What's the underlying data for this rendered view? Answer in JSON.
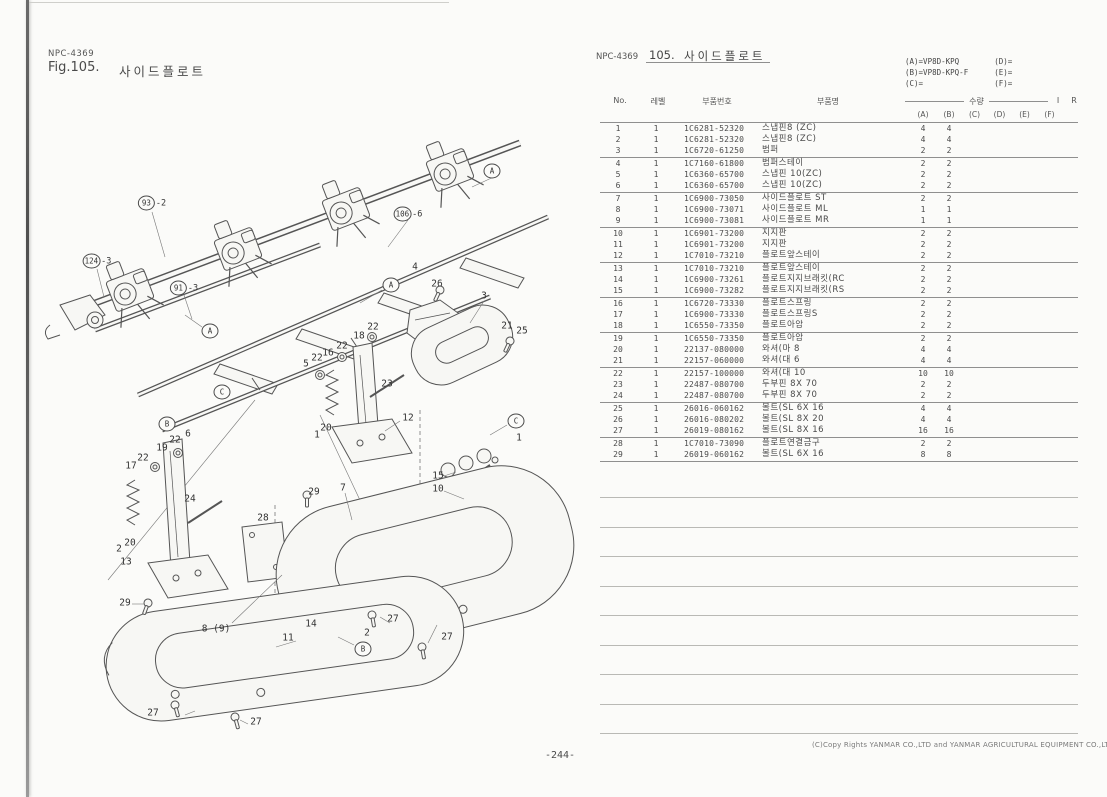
{
  "page": {
    "code_left": "NPC-4369",
    "fig_label": "Fig.105.",
    "fig_title": "사이드플로트",
    "code_right": "NPC-4369",
    "fig_no_right": "105.",
    "title_right": "사이드플로트",
    "footer_copyright": "(C)Copy Rights  YANMAR CO.,LTD and YANMAR AGRICULTURAL EQUIPMENT CO.,LTD.",
    "page_number": "-244-"
  },
  "models": [
    {
      "label": "(A)",
      "value": "VP8D-KPQ"
    },
    {
      "label": "(B)",
      "value": "VP8D-KPQ-F"
    },
    {
      "label": "(C)",
      "value": ""
    },
    {
      "label": "(D)",
      "value": ""
    },
    {
      "label": "(E)",
      "value": ""
    },
    {
      "label": "(F)",
      "value": ""
    }
  ],
  "table": {
    "col_no": "No.",
    "col_level": "레벨",
    "col_part_no": "부품번호",
    "col_part_name": "부품명",
    "col_qty": "수량",
    "col_i": "I",
    "col_r": "R",
    "qty_cols": [
      "(A)",
      "(B)",
      "(C)",
      "(D)",
      "(E)",
      "(F)"
    ],
    "rows": [
      {
        "no": "1",
        "level": "1",
        "part_no": "1C6281-52320",
        "name": "스냅핀8 (ZC)",
        "qa": "4",
        "qb": "4"
      },
      {
        "no": "2",
        "level": "1",
        "part_no": "1C6281-52320",
        "name": "스냅핀8 (ZC)",
        "qa": "4",
        "qb": "4"
      },
      {
        "no": "3",
        "level": "1",
        "part_no": "1C6720-61250",
        "name": "범퍼",
        "qa": "2",
        "qb": "2"
      },
      {
        "no": "4",
        "level": "1",
        "part_no": "1C7160-61800",
        "name": "범퍼스테이",
        "qa": "2",
        "qb": "2"
      },
      {
        "no": "5",
        "level": "1",
        "part_no": "1C6360-65700",
        "name": "스냅핀 10(ZC)",
        "qa": "2",
        "qb": "2"
      },
      {
        "no": "6",
        "level": "1",
        "part_no": "1C6360-65700",
        "name": "스냅핀 10(ZC)",
        "qa": "2",
        "qb": "2"
      },
      {
        "no": "7",
        "level": "1",
        "part_no": "1C6900-73050",
        "name": "사이드플로트 ST",
        "qa": "2",
        "qb": "2"
      },
      {
        "no": "8",
        "level": "1",
        "part_no": "1C6900-73071",
        "name": "사이드플로트 ML",
        "qa": "1",
        "qb": "1"
      },
      {
        "no": "9",
        "level": "1",
        "part_no": "1C6900-73081",
        "name": "사이드플로트 MR",
        "qa": "1",
        "qb": "1"
      },
      {
        "no": "10",
        "level": "1",
        "part_no": "1C6901-73200",
        "name": "지지판",
        "qa": "2",
        "qb": "2"
      },
      {
        "no": "11",
        "level": "1",
        "part_no": "1C6901-73200",
        "name": "지지판",
        "qa": "2",
        "qb": "2"
      },
      {
        "no": "12",
        "level": "1",
        "part_no": "1C7010-73210",
        "name": "플로트앞스테이",
        "qa": "2",
        "qb": "2"
      },
      {
        "no": "13",
        "level": "1",
        "part_no": "1C7010-73210",
        "name": "플로트앞스테이",
        "qa": "2",
        "qb": "2"
      },
      {
        "no": "14",
        "level": "1",
        "part_no": "1C6900-73261",
        "name": "플로트지지브래킷(RC",
        "qa": "2",
        "qb": "2"
      },
      {
        "no": "15",
        "level": "1",
        "part_no": "1C6900-73282",
        "name": "플로트지지브래킷(RS",
        "qa": "2",
        "qb": "2"
      },
      {
        "no": "16",
        "level": "1",
        "part_no": "1C6720-73330",
        "name": "플로트스프링",
        "qa": "2",
        "qb": "2"
      },
      {
        "no": "17",
        "level": "1",
        "part_no": "1C6900-73330",
        "name": "플로트스프링S",
        "qa": "2",
        "qb": "2"
      },
      {
        "no": "18",
        "level": "1",
        "part_no": "1C6550-73350",
        "name": "플로트아암",
        "qa": "2",
        "qb": "2"
      },
      {
        "no": "19",
        "level": "1",
        "part_no": "1C6550-73350",
        "name": "플로트아암",
        "qa": "2",
        "qb": "2"
      },
      {
        "no": "20",
        "level": "1",
        "part_no": "22137-080000",
        "name": "와셔(마 8",
        "qa": "4",
        "qb": "4"
      },
      {
        "no": "21",
        "level": "1",
        "part_no": "22157-060000",
        "name": "와셔(대 6",
        "qa": "4",
        "qb": "4"
      },
      {
        "no": "22",
        "level": "1",
        "part_no": "22157-100000",
        "name": "와셔(대 10",
        "qa": "10",
        "qb": "10"
      },
      {
        "no": "23",
        "level": "1",
        "part_no": "22487-080700",
        "name": "두부핀 8X 70",
        "qa": "2",
        "qb": "2"
      },
      {
        "no": "24",
        "level": "1",
        "part_no": "22487-080700",
        "name": "두부핀 8X 70",
        "qa": "2",
        "qb": "2"
      },
      {
        "no": "25",
        "level": "1",
        "part_no": "26016-060162",
        "name": "볼트(SL 6X 16",
        "qa": "4",
        "qb": "4"
      },
      {
        "no": "26",
        "level": "1",
        "part_no": "26016-080202",
        "name": "볼트(SL 8X 20",
        "qa": "4",
        "qb": "4"
      },
      {
        "no": "27",
        "level": "1",
        "part_no": "26019-080162",
        "name": "볼트(SL 8X 16",
        "qa": "16",
        "qb": "16"
      },
      {
        "no": "28",
        "level": "1",
        "part_no": "1C7010-73090",
        "name": "플로트연결금구",
        "qa": "2",
        "qb": "2"
      },
      {
        "no": "29",
        "level": "1",
        "part_no": "26019-060162",
        "name": "볼트(SL 6X 16",
        "qa": "8",
        "qb": "8"
      }
    ]
  },
  "diagram": {
    "callouts": [
      {
        "t": "93",
        "s": "-2",
        "c": true,
        "x": 152,
        "y": 203
      },
      {
        "t": "124",
        "s": "-3",
        "c": true,
        "x": 97,
        "y": 261
      },
      {
        "t": "91",
        "s": "-3",
        "c": true,
        "x": 184,
        "y": 288
      },
      {
        "t": "106",
        "s": "-6",
        "c": true,
        "x": 408,
        "y": 214
      },
      {
        "t": "A",
        "c": true,
        "x": 492,
        "y": 171
      },
      {
        "t": "A",
        "c": true,
        "x": 210,
        "y": 331
      },
      {
        "t": "A",
        "c": true,
        "x": 391,
        "y": 285
      },
      {
        "t": "B",
        "c": true,
        "x": 167,
        "y": 424
      },
      {
        "t": "B",
        "c": true,
        "x": 363,
        "y": 649
      },
      {
        "t": "C",
        "c": true,
        "x": 222,
        "y": 392
      },
      {
        "t": "C",
        "c": true,
        "x": 516,
        "y": 421
      },
      {
        "t": "4",
        "x": 415,
        "y": 267
      },
      {
        "t": "26",
        "x": 437,
        "y": 284
      },
      {
        "t": "3",
        "x": 484,
        "y": 296
      },
      {
        "t": "21",
        "x": 507,
        "y": 326
      },
      {
        "t": "25",
        "x": 522,
        "y": 331
      },
      {
        "t": "22",
        "x": 373,
        "y": 327
      },
      {
        "t": "18",
        "x": 359,
        "y": 336
      },
      {
        "t": "22",
        "x": 342,
        "y": 346
      },
      {
        "t": "16",
        "x": 328,
        "y": 353
      },
      {
        "t": "22",
        "x": 317,
        "y": 358
      },
      {
        "t": "5",
        "x": 306,
        "y": 364
      },
      {
        "t": "23",
        "x": 387,
        "y": 384
      },
      {
        "t": "12",
        "x": 408,
        "y": 418
      },
      {
        "t": "20",
        "x": 326,
        "y": 428
      },
      {
        "t": "1",
        "x": 317,
        "y": 435
      },
      {
        "t": "6",
        "x": 188,
        "y": 434
      },
      {
        "t": "22",
        "x": 175,
        "y": 440
      },
      {
        "t": "19",
        "x": 162,
        "y": 448
      },
      {
        "t": "22",
        "x": 143,
        "y": 458
      },
      {
        "t": "17",
        "x": 131,
        "y": 466
      },
      {
        "t": "24",
        "x": 190,
        "y": 499
      },
      {
        "t": "20",
        "x": 130,
        "y": 543
      },
      {
        "t": "2",
        "x": 119,
        "y": 549
      },
      {
        "t": "13",
        "x": 126,
        "y": 562
      },
      {
        "t": "28",
        "x": 263,
        "y": 518
      },
      {
        "t": "29",
        "x": 314,
        "y": 492
      },
      {
        "t": "7",
        "x": 343,
        "y": 488
      },
      {
        "t": "15",
        "x": 438,
        "y": 476
      },
      {
        "t": "10",
        "x": 438,
        "y": 489
      },
      {
        "t": "1",
        "x": 519,
        "y": 438
      },
      {
        "t": "29",
        "x": 125,
        "y": 603
      },
      {
        "t": "8 (9)",
        "x": 216,
        "y": 629
      },
      {
        "t": "11",
        "x": 288,
        "y": 638
      },
      {
        "t": "14",
        "x": 311,
        "y": 624
      },
      {
        "t": "2",
        "x": 367,
        "y": 633
      },
      {
        "t": "27",
        "x": 393,
        "y": 619
      },
      {
        "t": "27",
        "x": 447,
        "y": 637
      },
      {
        "t": "27",
        "x": 153,
        "y": 713
      },
      {
        "t": "27",
        "x": 256,
        "y": 722
      }
    ]
  }
}
